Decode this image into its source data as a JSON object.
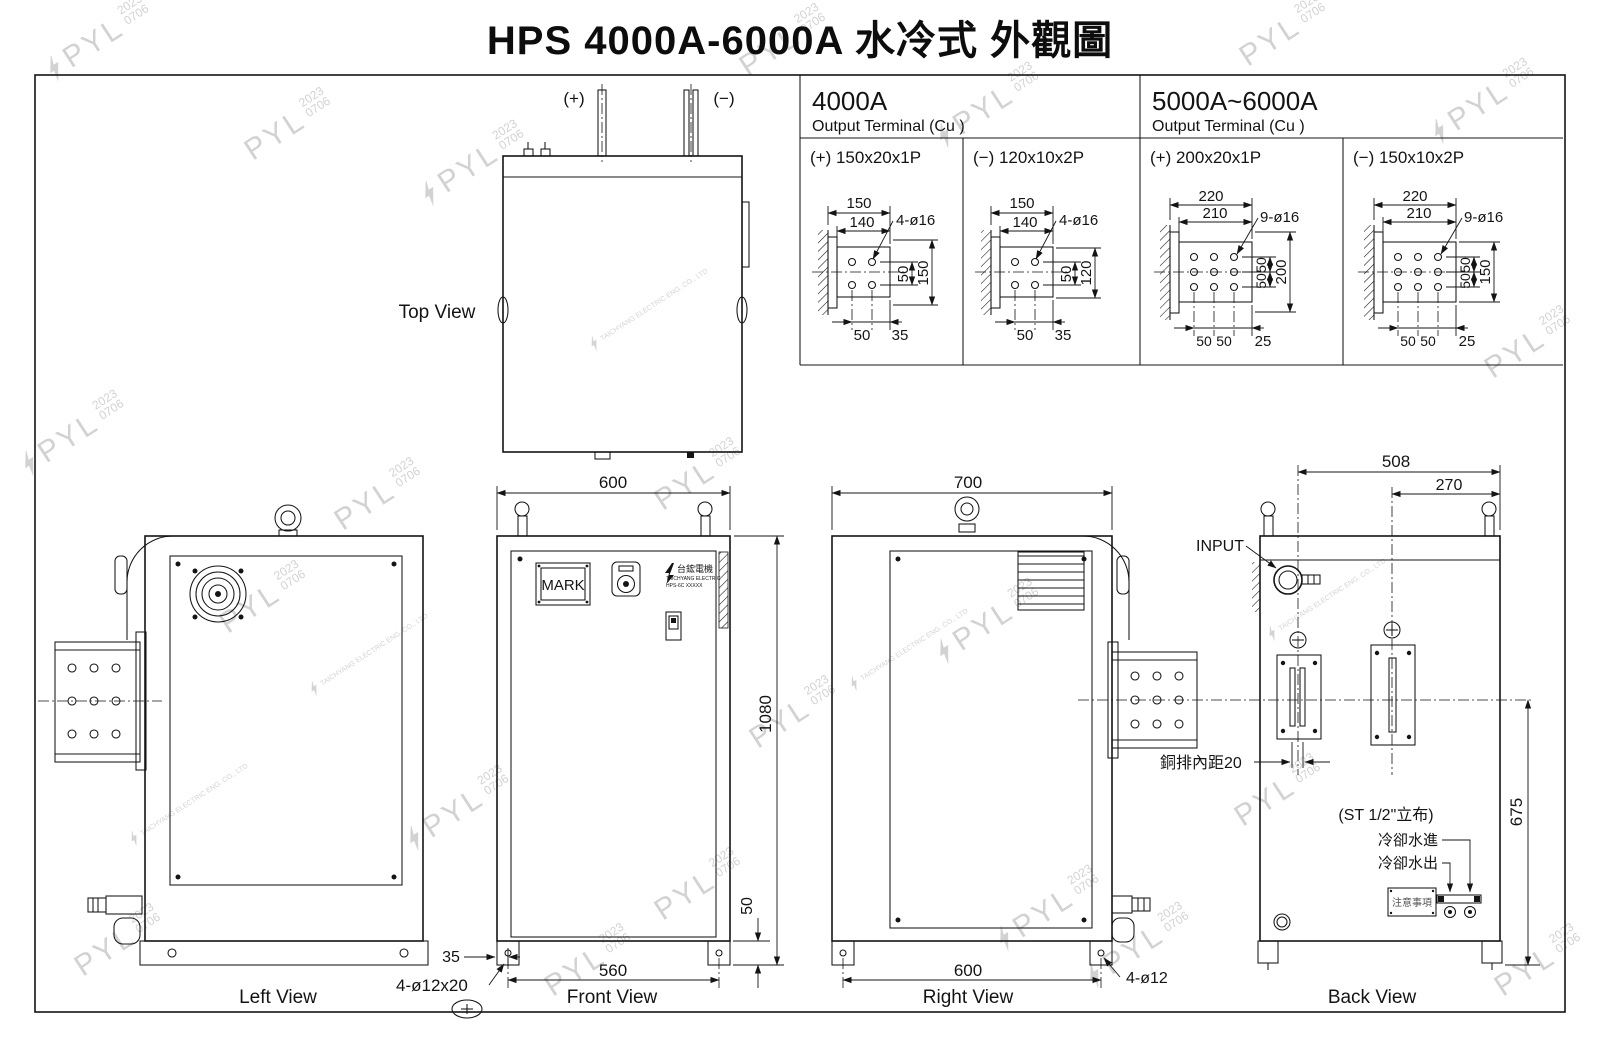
{
  "title": "HPS 4000A-6000A 水冷式 外觀圖",
  "watermark": {
    "brand": "PYL",
    "year": "2023",
    "code": "0706",
    "company": "TAICHYANG ELECTRIC ENG. CO., LTD"
  },
  "terminal_table": {
    "groups": [
      {
        "model": "4000A",
        "subtitle": "Output Terminal (Cu )",
        "cells": [
          {
            "label": "(+) 150x20x1P",
            "dim_width": "150",
            "dim_width2": "140",
            "holes": "4-ø16",
            "v_pitch": "50",
            "v_overall": "150",
            "h_pitch": "50",
            "h_edge": "35"
          },
          {
            "label": "(−) 120x10x2P",
            "dim_width": "150",
            "dim_width2": "140",
            "holes": "4-ø16",
            "v_pitch": "50",
            "v_overall": "120",
            "h_pitch": "50",
            "h_edge": "35"
          }
        ]
      },
      {
        "model": "5000A~6000A",
        "subtitle": "Output Terminal (Cu )",
        "cells": [
          {
            "label": "(+) 200x20x1P",
            "dim_width": "220",
            "dim_width2": "210",
            "holes": "9-ø16",
            "v_pitch": "50",
            "v_pitch2": "50",
            "v_overall": "200",
            "h_pitch": "50",
            "h_pitch2": "50",
            "h_edge": "25"
          },
          {
            "label": "(−) 150x10x2P",
            "dim_width": "220",
            "dim_width2": "210",
            "holes": "9-ø16",
            "v_pitch": "50",
            "v_pitch2": "50",
            "v_overall": "150",
            "h_pitch": "50",
            "h_pitch2": "50",
            "h_edge": "25"
          }
        ]
      }
    ]
  },
  "views": {
    "top": {
      "label": "Top View",
      "positive": "(+)",
      "negative": "(−)"
    },
    "left": {
      "label": "Left View"
    },
    "front": {
      "label": "Front View",
      "width": "600",
      "height": "1080",
      "foot_offset": "35",
      "foot_bolts": "4-ø12x20",
      "bolt_span": "560",
      "foot_height": "50",
      "mark_plate": "MARK",
      "brand_name": "台鋐電機",
      "brand_company": "TAICHYANG ELECTRIC",
      "brand_model": "HPS-6C XXXXX"
    },
    "right": {
      "label": "Right View",
      "width": "700",
      "bolt_span": "600",
      "foot_bolts": "4-ø12"
    },
    "back": {
      "label": "Back View",
      "dim_neg_edge": "508",
      "dim_pos_edge": "270",
      "input": "INPUT",
      "busbar_gap": "銅排內距20",
      "pipe_note": "(ST 1/2\"立布)",
      "water_in": "冷卻水進",
      "water_out": "冷卻水出",
      "notice": "注意事項",
      "dim_height": "675"
    }
  }
}
